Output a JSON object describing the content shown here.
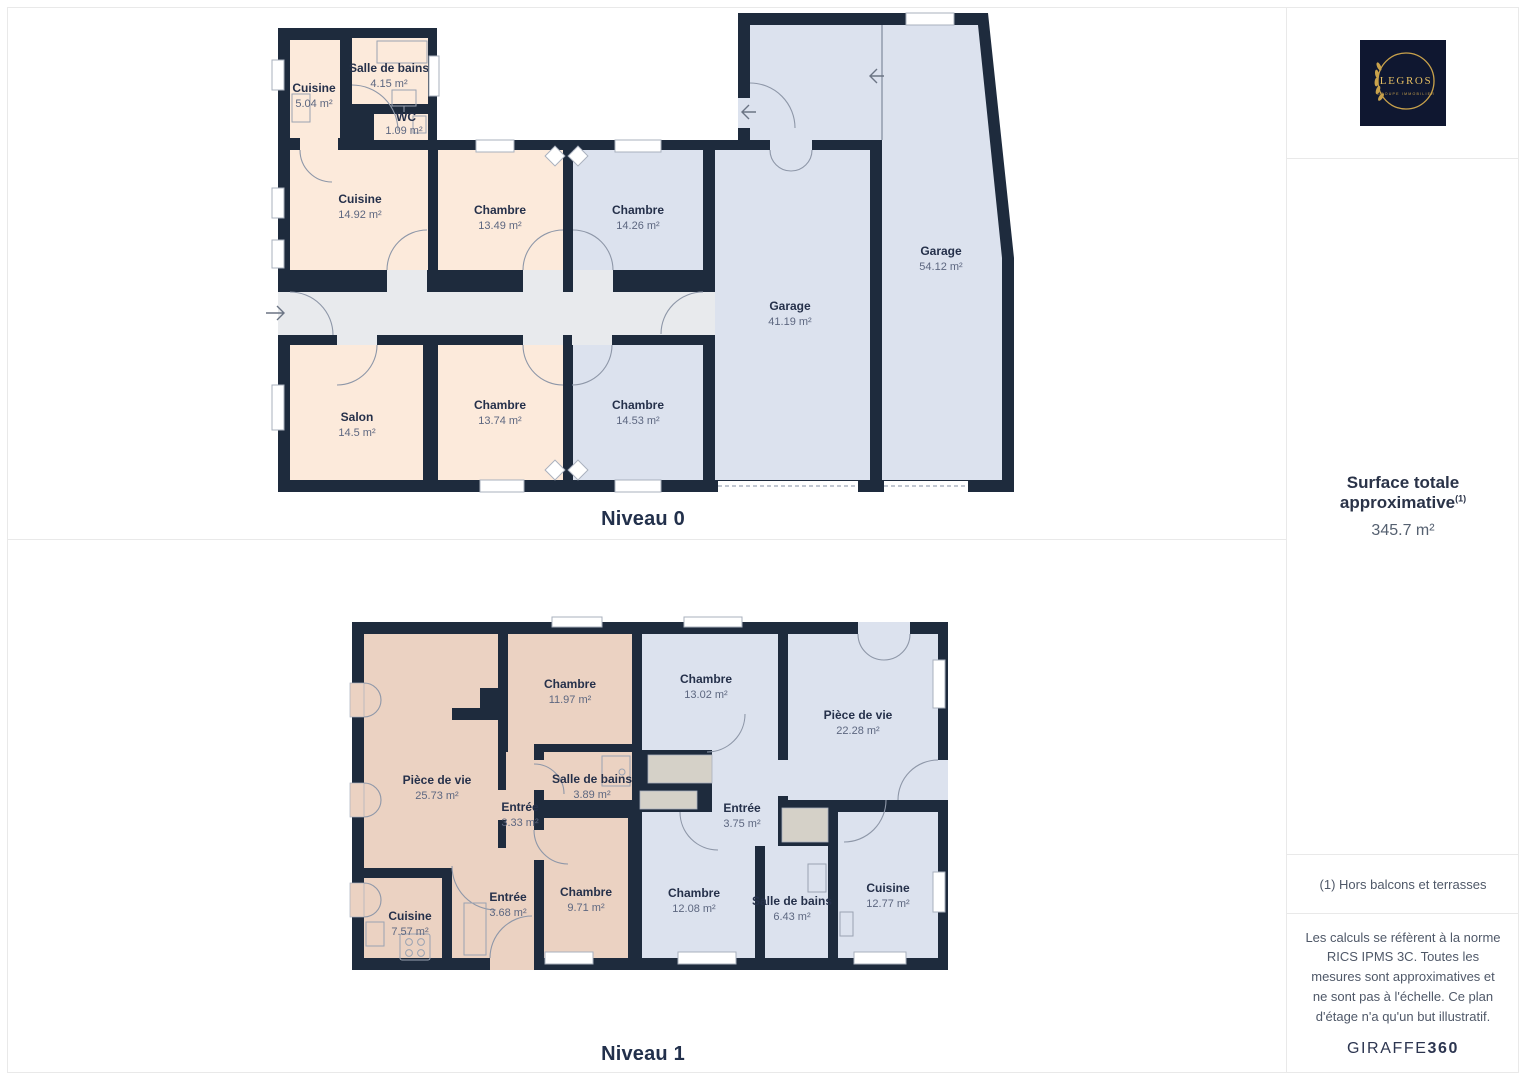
{
  "floors": [
    {
      "title": "Niveau 0",
      "rooms": [
        {
          "name": "Cuisine",
          "area": "5.04 m²"
        },
        {
          "name": "Salle de bains",
          "area": "4.15 m²"
        },
        {
          "name": "WC",
          "area": "1.09 m²"
        },
        {
          "name": "Cuisine",
          "area": "14.92 m²"
        },
        {
          "name": "Chambre",
          "area": "13.49 m²"
        },
        {
          "name": "Chambre",
          "area": "14.26 m²"
        },
        {
          "name": "Salon",
          "area": "14.5 m²"
        },
        {
          "name": "Chambre",
          "area": "13.74 m²"
        },
        {
          "name": "Chambre",
          "area": "14.53 m²"
        },
        {
          "name": "Garage",
          "area": "41.19 m²"
        },
        {
          "name": "Garage",
          "area": "54.12 m²"
        }
      ]
    },
    {
      "title": "Niveau 1",
      "rooms": [
        {
          "name": "Pièce de vie",
          "area": "25.73 m²"
        },
        {
          "name": "Chambre",
          "area": "11.97 m²"
        },
        {
          "name": "Entrée",
          "area": "3.33 m²"
        },
        {
          "name": "Salle de bains",
          "area": "3.89 m²"
        },
        {
          "name": "Chambre",
          "area": "9.71 m²"
        },
        {
          "name": "Entrée",
          "area": "3.68 m²"
        },
        {
          "name": "Cuisine",
          "area": "7.57 m²"
        },
        {
          "name": "Chambre",
          "area": "13.02 m²"
        },
        {
          "name": "Pièce de vie",
          "area": "22.28 m²"
        },
        {
          "name": "Entrée",
          "area": "3.75 m²"
        },
        {
          "name": "Chambre",
          "area": "12.08 m²"
        },
        {
          "name": "Salle de bains",
          "area": "6.43 m²"
        },
        {
          "name": "Cuisine",
          "area": "12.77 m²"
        }
      ]
    }
  ],
  "sidebar": {
    "logo": {
      "brand": "LEGROS",
      "subtitle": "GROUPE IMMOBILIER"
    },
    "surface": {
      "title": "Surface totale approximative",
      "sup": "(1)",
      "value": "345.7 m²"
    },
    "note": "(1) Hors balcons et terrasses",
    "legal": "Les calculs se réfèrent à la norme RICS IPMS 3C. Toutes les mesures sont approximatives et ne sont pas à l'échelle. Ce plan d'étage n'a qu'un but illustratif.",
    "brand": {
      "name": "GIRAFFE",
      "number": "360"
    }
  },
  "colors": {
    "wall": "#1e2b3d",
    "room_cream": "#fceadb",
    "room_tan": "#ebd2c2",
    "room_blue": "#dce2ee",
    "corridor": "#e8eaed",
    "closet": "#d5d1c8",
    "label": "#25304a",
    "area_text": "#5d6780",
    "logo_gold": "#c9a24b",
    "logo_bg": "#0f1730"
  }
}
